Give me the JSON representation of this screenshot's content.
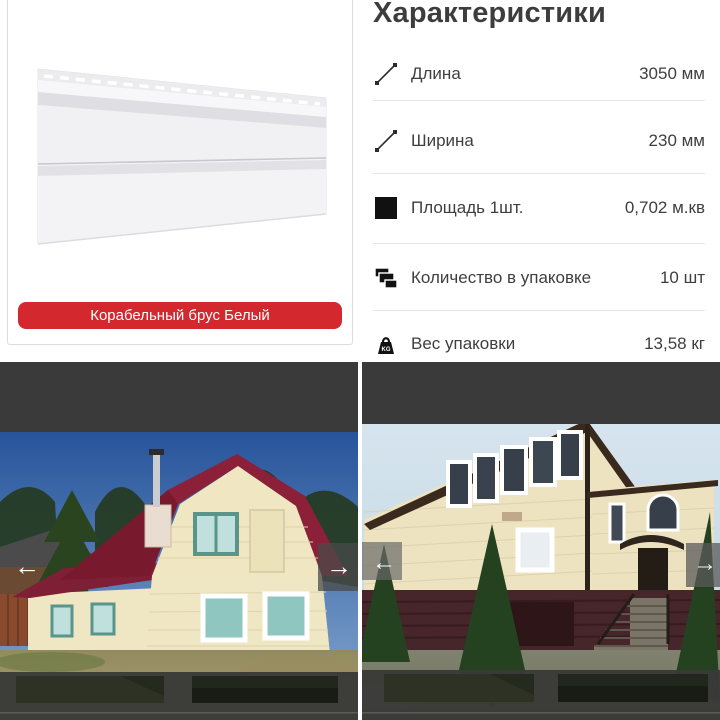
{
  "specs": {
    "title": "Характеристики",
    "weight_icon_text": "KG",
    "rows": [
      {
        "icon": "diagonal-length-icon",
        "label": "Длина",
        "value": "3050 мм"
      },
      {
        "icon": "diagonal-width-icon",
        "label": "Ширина",
        "value": "230 мм"
      },
      {
        "icon": "filled-square-icon",
        "label": "Площадь 1шт.",
        "value": "0,702 м.кв"
      },
      {
        "icon": "stacked-panels-icon",
        "label": "Количество в упаковке",
        "value": "10 шт"
      },
      {
        "icon": "weight-kg-icon",
        "label": "Вес упаковки",
        "value": "13,58 кг"
      }
    ]
  },
  "product": {
    "variant_button_label": "Корабельный брус Белый",
    "image_alt": "white-vinyl-siding-panel",
    "accent_color": "#d2282e"
  },
  "carousel": {
    "prev_icon": "←",
    "next_icon": "→",
    "photos": [
      {
        "alt": "house-with-maroon-gambrel-roof-and-cream-siding"
      },
      {
        "alt": "two-story-house-with-cream-siding-and-brown-basement"
      }
    ]
  },
  "colors": {
    "dark_bar": "#3a3a3a",
    "thumb_strip": "#3a3a38",
    "separator": "#e5e5e5",
    "text": "#3f3f3f"
  }
}
